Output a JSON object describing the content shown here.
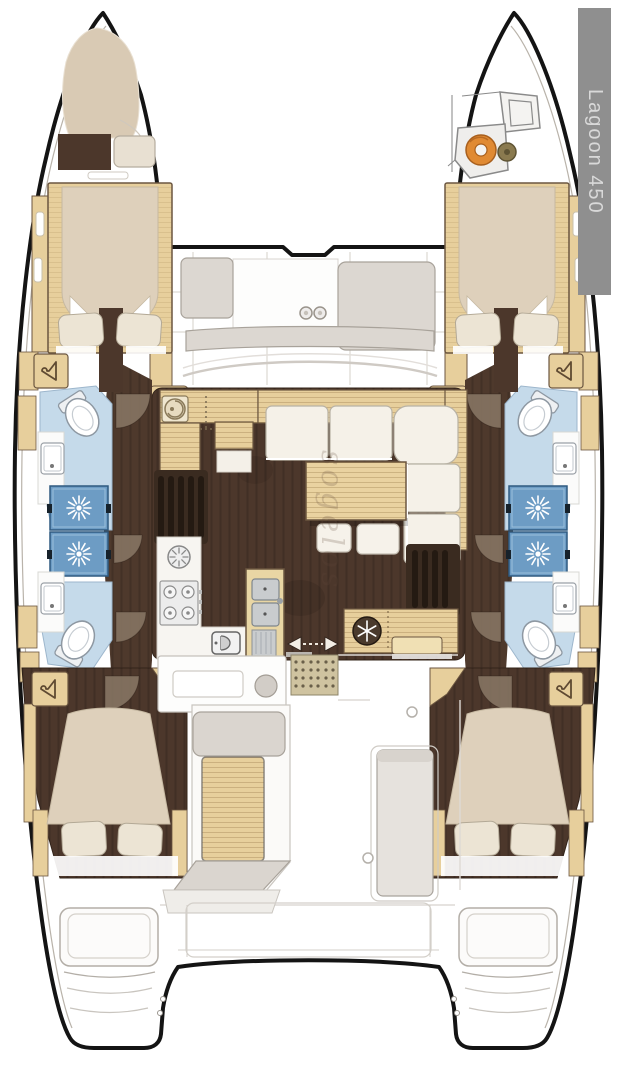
{
  "page": {
    "type": "catamaran-deck-layout-plan",
    "title": "Lagoon 450 layout plan"
  },
  "badge": {
    "label": "Lagoon 450"
  },
  "watermark": {
    "text": "sogelos"
  },
  "colors": {
    "hull_outline": "#141414",
    "wood_light": "#e7cf9c",
    "wood_border": "#6b5640",
    "floor_dark_brown": "#4c372b",
    "corridor_brown": "#4e392c",
    "door_arc_brown": "#8a7866",
    "mattress_beige": "#ded0bb",
    "pillow_cream": "#ece4d4",
    "sofa_cream": "#f5f1e8",
    "seat_gray": "#dcd7d1",
    "bath_floor_blue": "#c5daea",
    "shower_blue": "#6d9cc4",
    "rope_orange": "#e08a33",
    "badge_bg": "#8f8f8f",
    "badge_text": "#d9d9d9"
  },
  "icons": [
    "hanger-icon",
    "shower-drain-icon",
    "snowflake-fridge-icon",
    "round-sink-icon",
    "burner-fan-icon",
    "stove-burners-icon",
    "double-sink-icon",
    "oven-icon",
    "cupholder-icon",
    "slide-door-arrow-icon",
    "rope-coil-icon"
  ]
}
